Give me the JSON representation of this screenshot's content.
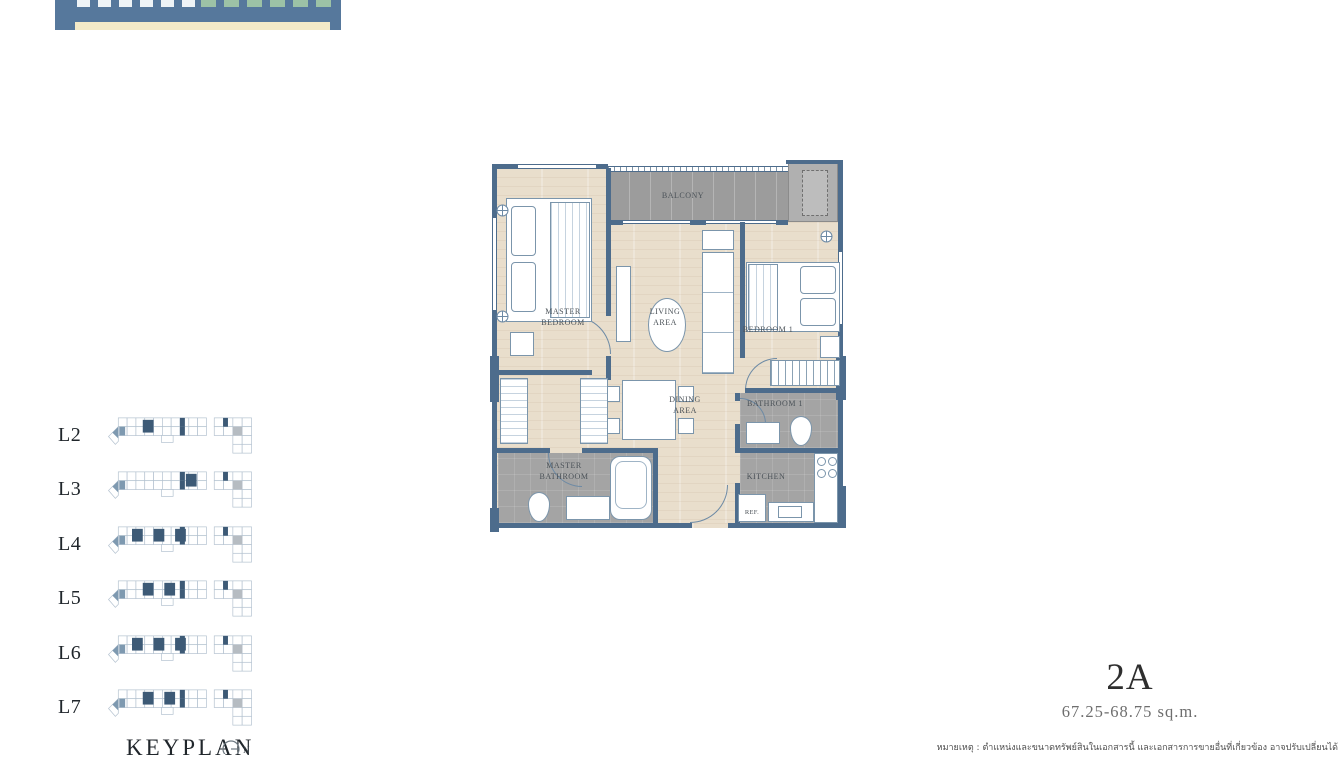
{
  "brand": {
    "bar_color": "#56789c",
    "underline_color": "#f3eac8",
    "glyph_color_left": "#eef3f6",
    "glyph_color_right": "#9cc2a6"
  },
  "unit": {
    "code": "2A",
    "area_range": "67.25-68.75 sq.m."
  },
  "keyplan": {
    "title": "KEYPLAN",
    "north_label": "N",
    "highlight_color": "#3d5a76",
    "levels": [
      {
        "label": "L2",
        "highlights": [
          2
        ]
      },
      {
        "label": "L3",
        "highlights": [
          6
        ]
      },
      {
        "label": "L4",
        "highlights": [
          1,
          3,
          5
        ]
      },
      {
        "label": "L5",
        "highlights": [
          2,
          4
        ]
      },
      {
        "label": "L6",
        "highlights": [
          1,
          3,
          5
        ]
      },
      {
        "label": "L7",
        "highlights": [
          2,
          4
        ]
      }
    ]
  },
  "floorplan": {
    "wall_color": "#4d6c8c",
    "labels": {
      "master_bedroom": "MASTER BEDROOM",
      "balcony": "BALCONY",
      "living_area": "LIVING AREA",
      "bedroom1": "BEDROOM 1",
      "dining_area": "DINING AREA",
      "bathroom1": "BATHROOM 1",
      "master_bathroom": "MASTER BATHROOM",
      "kitchen": "KITCHEN",
      "ref": "REF."
    }
  },
  "disclaimer": "หมายเหตุ : ตำแหน่งและขนาดทรัพย์สินในเอกสารนี้ และเอกสารการขายอื่นที่เกี่ยวข้อง อาจปรับเปลี่ยนได้"
}
